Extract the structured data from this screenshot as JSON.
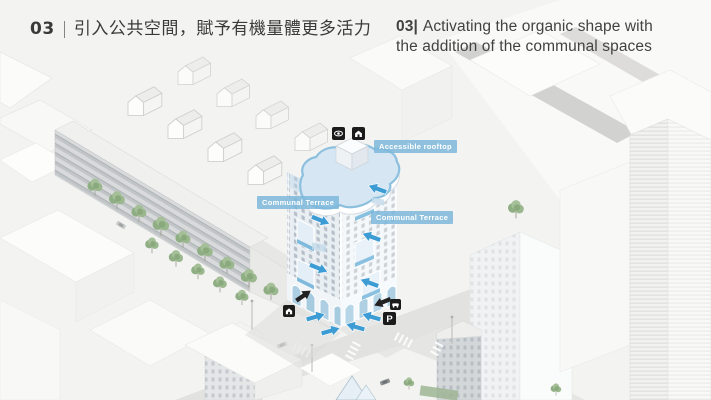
{
  "slide": {
    "title_zh": {
      "number": "03",
      "divider": "|",
      "text": "引入公共空間，賦予有機量體更多活力"
    },
    "title_en": {
      "number": "03|",
      "line1": "Activating the organic shape with",
      "line2": "the addition of the communal spaces"
    }
  },
  "annotations": {
    "rooftop_label": "Accessible rooftop",
    "terrace_label_left": "Communal Terrace",
    "terrace_label_right": "Communal Terrace",
    "parking_glyph": "P"
  },
  "icons": {
    "roof": [
      "eye-icon",
      "house-icon"
    ],
    "ground": [
      "house-icon",
      "car-icon",
      "parking-icon"
    ]
  },
  "colors": {
    "accent": "#3d9cd4",
    "label_bg": "#7cb7da",
    "roof_tint": "#d6e7f3",
    "title_text": "#3c3c3c"
  }
}
